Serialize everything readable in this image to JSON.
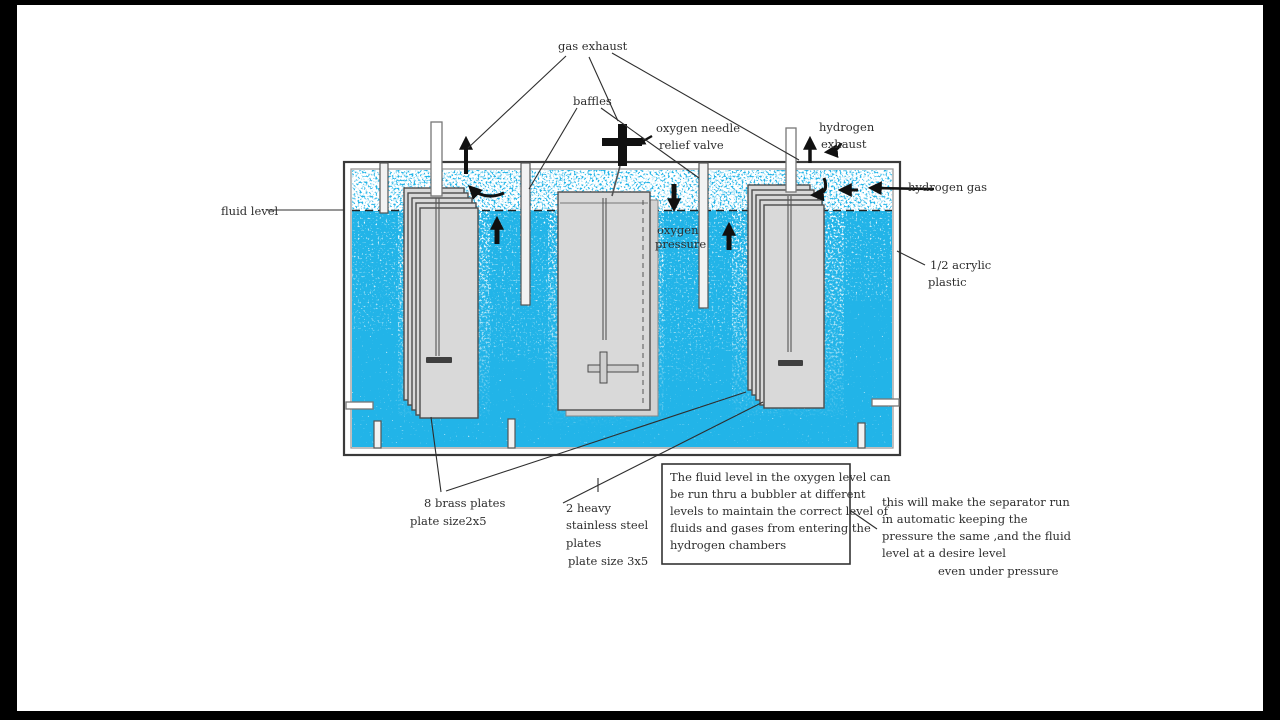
{
  "colors": {
    "letterbox": "#000000",
    "canvas": "#ffffff",
    "fluid": "#22b4e8",
    "plate_fill": "#d9d9d9",
    "plate_stroke": "#4d4d4d",
    "ink": "#2e2e2e",
    "arrow": "#111111"
  },
  "labels": {
    "gas_exhaust": "gas exhaust",
    "baffles": "baffles",
    "oxygen_needle_line1": "oxygen needle",
    "oxygen_needle_line2": "relief valve",
    "hydrogen_exhaust_line1": "hydrogen",
    "hydrogen_exhaust_line2": "exhaust",
    "hydrogen_gas": "hydrogen gas",
    "fluid_level": "fluid level",
    "acrylic_line1": "1/2 acrylic",
    "acrylic_line2": "plastic",
    "oxygen_pressure_line1": "oxygen",
    "oxygen_pressure_line2": "pressure",
    "brass_plates_line1": "8 brass plates",
    "brass_plates_line2": "plate size2x5",
    "steel_plates_line1": "2 heavy",
    "steel_plates_line2": "stainless steel",
    "steel_plates_line3": "plates",
    "steel_plates_line4": "plate size 3x5"
  },
  "polarity": {
    "center_plate": "+",
    "outer_plates": "-"
  },
  "note_box": {
    "lines": [
      "The fluid level in the oxygen level can",
      "be run thru a bubbler at different",
      "levels to maintain the correct level of",
      "fluids and gases from entering the",
      "hydrogen chambers"
    ]
  },
  "side_note": {
    "lines": [
      "this will make the separator run",
      "in automatic keeping the",
      "pressure the same ,and the fluid",
      "level at a desire level",
      "even under pressure"
    ]
  }
}
